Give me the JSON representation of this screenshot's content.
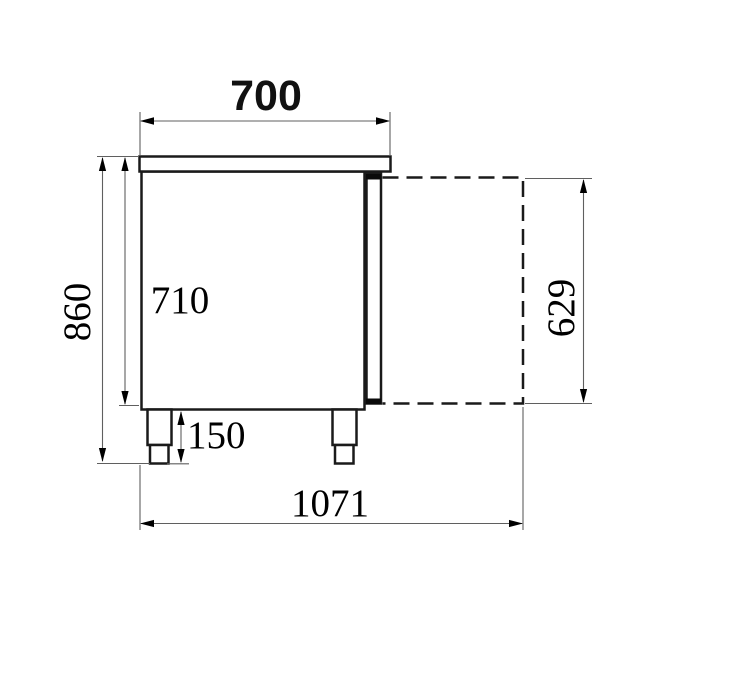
{
  "drawing": {
    "labels": {
      "width_top": "700",
      "height_total": "860",
      "height_body": "710",
      "height_leg": "150",
      "door_open_depth": "629",
      "total_depth_door_open": "1071"
    },
    "colors": {
      "outline": "#1a1a1a",
      "dimension_line": "#5f5f5f",
      "label_text": "#000000",
      "background": "#ffffff"
    }
  }
}
